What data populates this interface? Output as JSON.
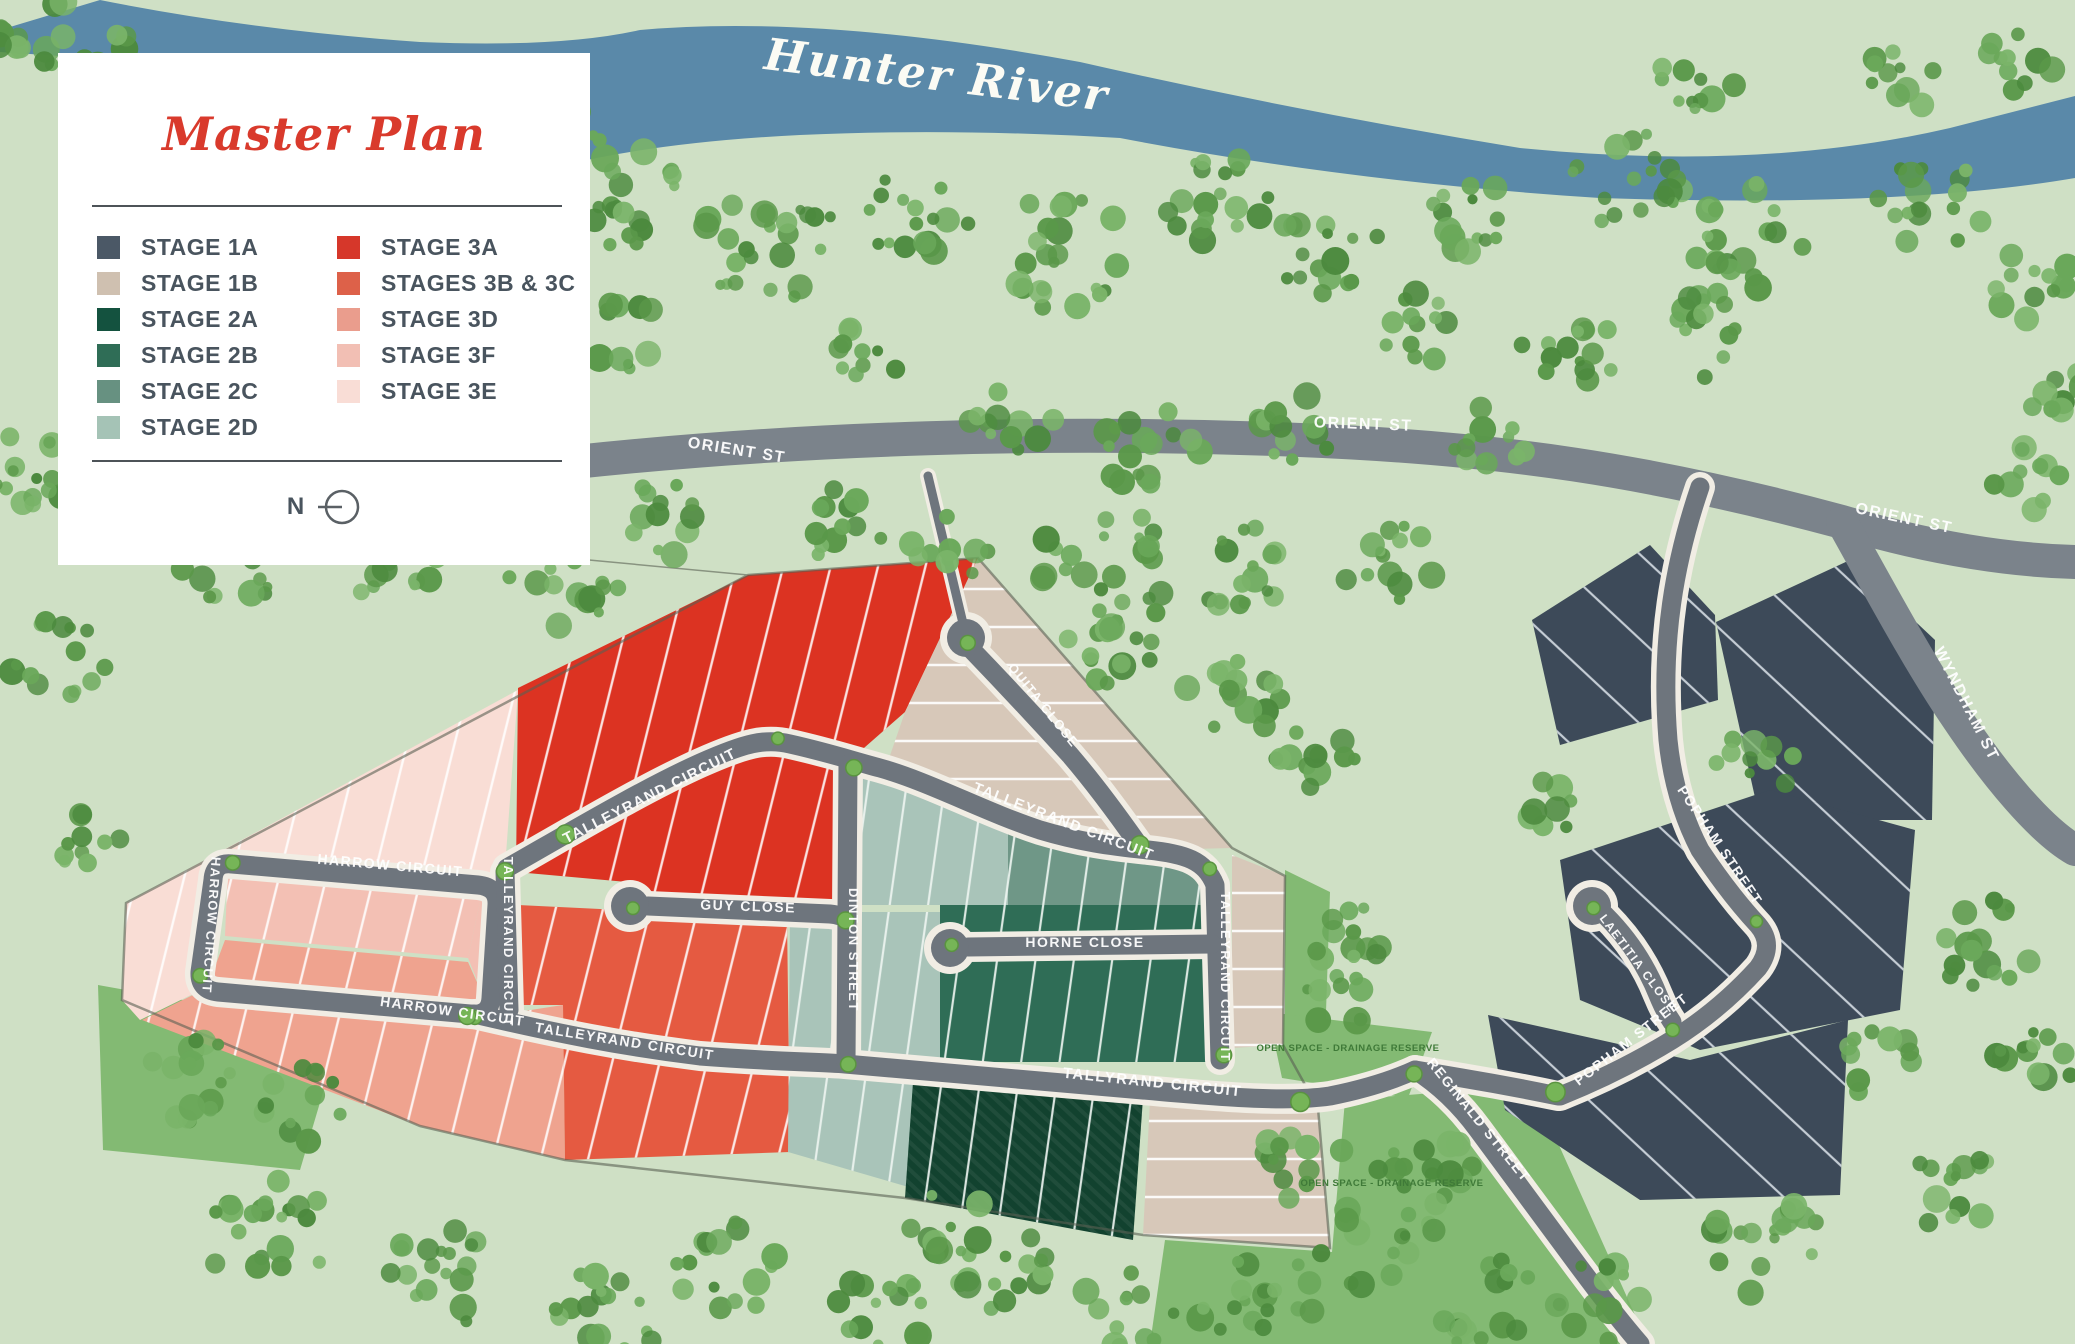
{
  "legend": {
    "title": "Master Plan",
    "title_color": "#d93a2c",
    "north_label": "N",
    "left_items": [
      {
        "label": "STAGE 1A",
        "color": "#4b5866"
      },
      {
        "label": "STAGE 1B",
        "color": "#cfc0b0"
      },
      {
        "label": "STAGE 2A",
        "color": "#14523f"
      },
      {
        "label": "STAGE 2B",
        "color": "#2f6d56"
      },
      {
        "label": "STAGE 2C",
        "color": "#679181"
      },
      {
        "label": "STAGE 2D",
        "color": "#a5c3b6"
      }
    ],
    "right_items": [
      {
        "label": "STAGE 3A",
        "color": "#d6372a"
      },
      {
        "label": "STAGES 3B & 3C",
        "color": "#dd6149"
      },
      {
        "label": "STAGE 3D",
        "color": "#ea9d8d"
      },
      {
        "label": "STAGE 3F",
        "color": "#f2bfb4"
      },
      {
        "label": "STAGE 3E",
        "color": "#f9ddd6"
      }
    ]
  },
  "map": {
    "river_label": "Hunter River",
    "colors": {
      "background": "#cfe0c5",
      "river": "#5a89a9",
      "river_text": "#fbfbf4",
      "park": "#83ba73",
      "park_text": "#3f7a38",
      "road": "#6e757d",
      "road_casing": "#f1ede4",
      "highway": "#7b838b",
      "boundary": "#5a6153",
      "verge": "#76b557",
      "verge_edge": "#5a9440",
      "s1a": "#3d4a59",
      "s1b": "#d7c8b9",
      "s2a": "#12422f",
      "s2b": "#2f6d56",
      "s2c": "#6f9787",
      "s2d": "#a9c4b9",
      "s3a": "#dc3322",
      "s3bc": "#e55a41",
      "s3d": "#efa38f",
      "s3f": "#f3c0b4",
      "s3e": "#f9ddd5",
      "tree_palette": [
        "#4c8a3e",
        "#5a9849",
        "#6aa85a",
        "#7ab469"
      ]
    },
    "road_labels": [
      {
        "t": "ORIENT ST",
        "x": 736,
        "y": 455,
        "r": 9,
        "s": 16
      },
      {
        "t": "ORIENT ST",
        "x": 1363,
        "y": 429,
        "r": 2,
        "s": 16
      },
      {
        "t": "ORIENT ST",
        "x": 1903,
        "y": 523,
        "r": 12,
        "s": 16
      },
      {
        "t": "WYNDHAM ST",
        "x": 1962,
        "y": 706,
        "r": 63,
        "s": 16
      },
      {
        "t": "TALLEYRAND CIRCUIT",
        "x": 652,
        "y": 800,
        "r": -27,
        "s": 15
      },
      {
        "t": "TALLEYRAND CIRCUIT",
        "x": 1062,
        "y": 826,
        "r": 21,
        "s": 15
      },
      {
        "t": "TALLEYRAND CIRCUIT",
        "x": 504,
        "y": 942,
        "r": 90,
        "s": 13
      },
      {
        "t": "TALLEYRAND CIRCUIT",
        "x": 1221,
        "y": 977,
        "r": 90,
        "s": 13
      },
      {
        "t": "TALLEYRAND CIRCUIT",
        "x": 624,
        "y": 1046,
        "r": 9,
        "s": 14
      },
      {
        "t": "TALLYRAND CIRCUIT",
        "x": 1152,
        "y": 1087,
        "r": 6,
        "s": 15
      },
      {
        "t": "HARROW CIRCUIT",
        "x": 390,
        "y": 870,
        "r": 5,
        "s": 14
      },
      {
        "t": "HARROW CIRCUIT",
        "x": 207,
        "y": 925,
        "r": 94,
        "s": 13
      },
      {
        "t": "HARROW CIRCUIT",
        "x": 452,
        "y": 1016,
        "r": 8,
        "s": 14
      },
      {
        "t": "GUY CLOSE",
        "x": 748,
        "y": 911,
        "r": 2,
        "s": 14
      },
      {
        "t": "DINTON STREET",
        "x": 849,
        "y": 950,
        "r": 90,
        "s": 13
      },
      {
        "t": "HORNE CLOSE",
        "x": 1085,
        "y": 947,
        "r": 0,
        "s": 14
      },
      {
        "t": "QUITA CLOSE",
        "x": 1040,
        "y": 708,
        "r": 51,
        "s": 13
      },
      {
        "t": "POPHAM STREET",
        "x": 1716,
        "y": 848,
        "r": 56,
        "s": 14
      },
      {
        "t": "POPHAM STREET",
        "x": 1634,
        "y": 1043,
        "r": -38,
        "s": 14
      },
      {
        "t": "LAETITIA CLOSE",
        "x": 1635,
        "y": 966,
        "r": 53,
        "s": 12
      },
      {
        "t": "REGINALD STREET",
        "x": 1475,
        "y": 1123,
        "r": 51,
        "s": 14
      }
    ],
    "park_labels": [
      {
        "t": "OPEN SPACE - DRAINAGE RESERVE",
        "x": 1348,
        "y": 1051
      },
      {
        "t": "OPEN SPACE - DRAINAGE RESERVE",
        "x": 1392,
        "y": 1186
      }
    ]
  }
}
